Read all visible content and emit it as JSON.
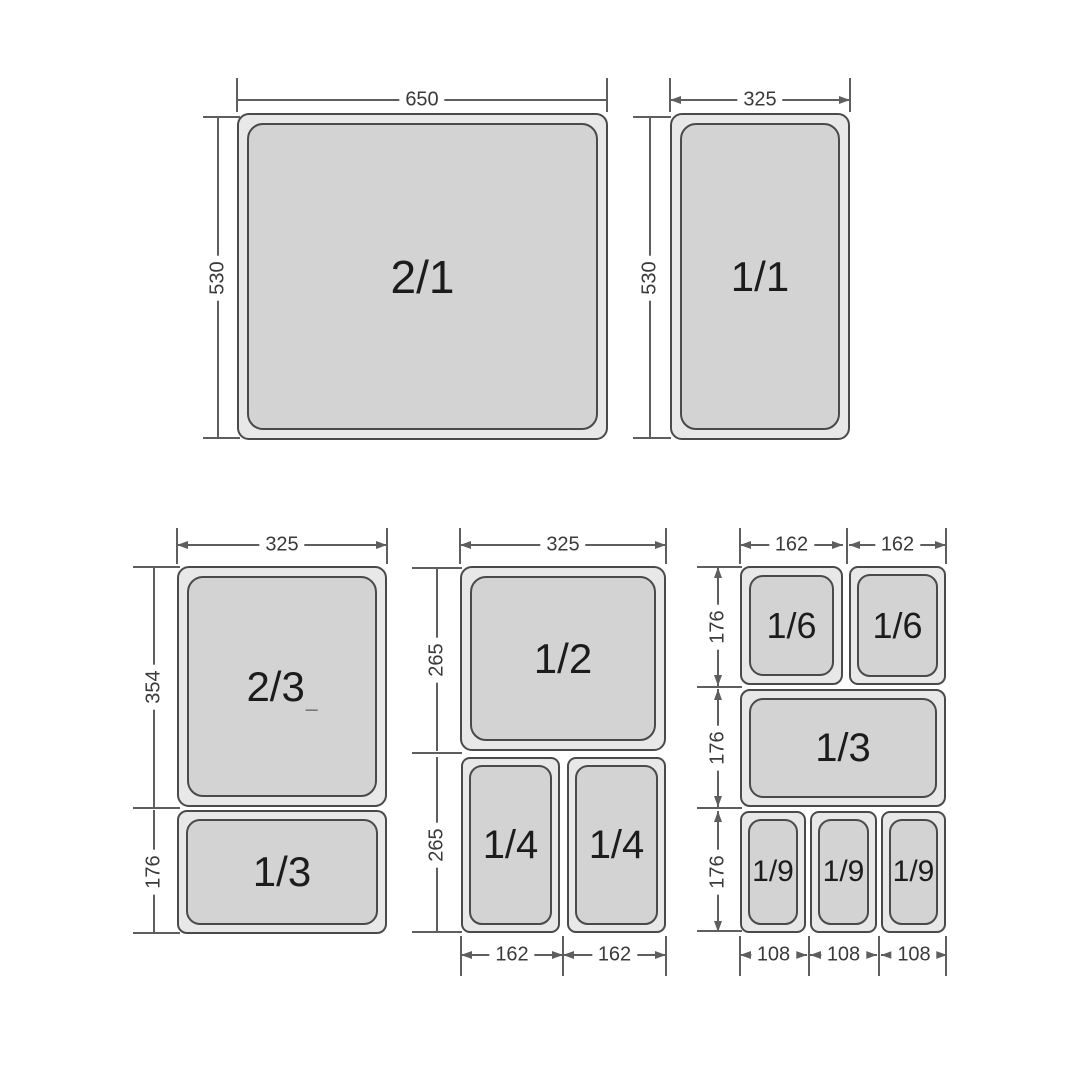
{
  "colors": {
    "background": "#ffffff",
    "pan_fill": "#d2d3d2",
    "pan_rim": "#e8e8e8",
    "pan_border": "#4a4a4a",
    "line": "#5e5e5e",
    "dim_text": "#3a3a3a",
    "pan_text": "#1c1c1c"
  },
  "pans": [
    {
      "label": "2/1",
      "x": 237,
      "y": 113,
      "w": 371,
      "h": 327,
      "fs": 46
    },
    {
      "label": "1/1",
      "x": 670,
      "y": 113,
      "w": 180,
      "h": 327,
      "fs": 42
    },
    {
      "label": "2/3",
      "suffix": "_",
      "x": 177,
      "y": 566,
      "w": 210,
      "h": 241,
      "fs": 42
    },
    {
      "label": "1/3",
      "x": 177,
      "y": 810,
      "w": 210,
      "h": 124,
      "fs": 42
    },
    {
      "label": "1/2",
      "x": 460,
      "y": 566,
      "w": 206,
      "h": 185,
      "fs": 42
    },
    {
      "label": "1/4",
      "x": 461,
      "y": 757,
      "w": 99,
      "h": 176,
      "fs": 40
    },
    {
      "label": "1/4",
      "x": 567,
      "y": 757,
      "w": 99,
      "h": 176,
      "fs": 40
    },
    {
      "label": "1/6",
      "x": 740,
      "y": 566,
      "w": 103,
      "h": 119,
      "fs": 36
    },
    {
      "label": "1/6",
      "x": 849,
      "y": 566,
      "w": 97,
      "h": 119,
      "fs": 36
    },
    {
      "label": "1/3",
      "x": 740,
      "y": 689,
      "w": 206,
      "h": 118,
      "fs": 40
    },
    {
      "label": "1/9",
      "x": 740,
      "y": 811,
      "w": 66,
      "h": 122,
      "fs": 30
    },
    {
      "label": "1/9",
      "x": 810,
      "y": 811,
      "w": 67,
      "h": 122,
      "fs": 30
    },
    {
      "label": "1/9",
      "x": 881,
      "y": 811,
      "w": 65,
      "h": 122,
      "fs": 30
    }
  ],
  "hdims": [
    {
      "text": "650",
      "x1": 237,
      "x2": 607,
      "y": 100,
      "arrows": false
    },
    {
      "text": "325",
      "x1": 670,
      "x2": 850,
      "y": 100,
      "arrows": true
    },
    {
      "text": "325",
      "x1": 177,
      "x2": 387,
      "y": 545,
      "arrows": true
    },
    {
      "text": "325",
      "x1": 460,
      "x2": 666,
      "y": 545,
      "arrows": true
    },
    {
      "text": "162",
      "x1": 740,
      "x2": 843,
      "y": 545,
      "arrows": true
    },
    {
      "text": "162",
      "x1": 849,
      "x2": 946,
      "y": 545,
      "arrows": true
    },
    {
      "text": "162",
      "x1": 461,
      "x2": 563,
      "y": 955,
      "arrows": true
    },
    {
      "text": "162",
      "x1": 563,
      "x2": 666,
      "y": 955,
      "arrows": true
    },
    {
      "text": "108",
      "x1": 740,
      "x2": 807,
      "y": 955,
      "arrows": true
    },
    {
      "text": "108",
      "x1": 810,
      "x2": 877,
      "y": 955,
      "arrows": true
    },
    {
      "text": "108",
      "x1": 881,
      "x2": 947,
      "y": 955,
      "arrows": true
    }
  ],
  "vdims": [
    {
      "text": "530",
      "x": 218,
      "y1": 117,
      "y2": 438,
      "arrows": false
    },
    {
      "text": "530",
      "x": 650,
      "y1": 117,
      "y2": 438,
      "arrows": false
    },
    {
      "text": "354",
      "x": 154,
      "y1": 567,
      "y2": 807,
      "arrows": false
    },
    {
      "text": "176",
      "x": 154,
      "y1": 810,
      "y2": 933,
      "arrows": false
    },
    {
      "text": "265",
      "x": 437,
      "y1": 568,
      "y2": 751,
      "arrows": false
    },
    {
      "text": "265",
      "x": 437,
      "y1": 757,
      "y2": 932,
      "arrows": false
    },
    {
      "text": "176",
      "x": 718,
      "y1": 567,
      "y2": 686,
      "arrows": true
    },
    {
      "text": "176",
      "x": 718,
      "y1": 689,
      "y2": 807,
      "arrows": true
    },
    {
      "text": "176",
      "x": 718,
      "y1": 811,
      "y2": 932,
      "arrows": true
    }
  ],
  "ext_vlines": [
    {
      "x": 237,
      "y1": 78,
      "y2": 112
    },
    {
      "x": 607,
      "y1": 78,
      "y2": 112
    },
    {
      "x": 670,
      "y1": 78,
      "y2": 112
    },
    {
      "x": 850,
      "y1": 78,
      "y2": 112
    },
    {
      "x": 177,
      "y1": 528,
      "y2": 564
    },
    {
      "x": 387,
      "y1": 528,
      "y2": 564
    },
    {
      "x": 460,
      "y1": 528,
      "y2": 564
    },
    {
      "x": 666,
      "y1": 528,
      "y2": 564
    },
    {
      "x": 740,
      "y1": 528,
      "y2": 564
    },
    {
      "x": 847,
      "y1": 528,
      "y2": 564
    },
    {
      "x": 946,
      "y1": 528,
      "y2": 564
    },
    {
      "x": 461,
      "y1": 936,
      "y2": 976
    },
    {
      "x": 563,
      "y1": 936,
      "y2": 976
    },
    {
      "x": 666,
      "y1": 936,
      "y2": 976
    },
    {
      "x": 740,
      "y1": 936,
      "y2": 976
    },
    {
      "x": 809,
      "y1": 936,
      "y2": 976
    },
    {
      "x": 879,
      "y1": 936,
      "y2": 976
    },
    {
      "x": 946,
      "y1": 936,
      "y2": 976
    }
  ],
  "ext_hlines": [
    {
      "y": 117,
      "x1": 203,
      "x2": 240
    },
    {
      "y": 438,
      "x1": 203,
      "x2": 240
    },
    {
      "y": 117,
      "x1": 633,
      "x2": 671
    },
    {
      "y": 438,
      "x1": 633,
      "x2": 671
    },
    {
      "y": 567,
      "x1": 133,
      "x2": 180
    },
    {
      "y": 808,
      "x1": 133,
      "x2": 180
    },
    {
      "y": 933,
      "x1": 133,
      "x2": 180
    },
    {
      "y": 568,
      "x1": 412,
      "x2": 462
    },
    {
      "y": 753,
      "x1": 412,
      "x2": 462
    },
    {
      "y": 932,
      "x1": 412,
      "x2": 462
    },
    {
      "y": 567,
      "x1": 697,
      "x2": 742
    },
    {
      "y": 687,
      "x1": 697,
      "x2": 742
    },
    {
      "y": 808,
      "x1": 697,
      "x2": 742
    },
    {
      "y": 931,
      "x1": 697,
      "x2": 742
    }
  ]
}
